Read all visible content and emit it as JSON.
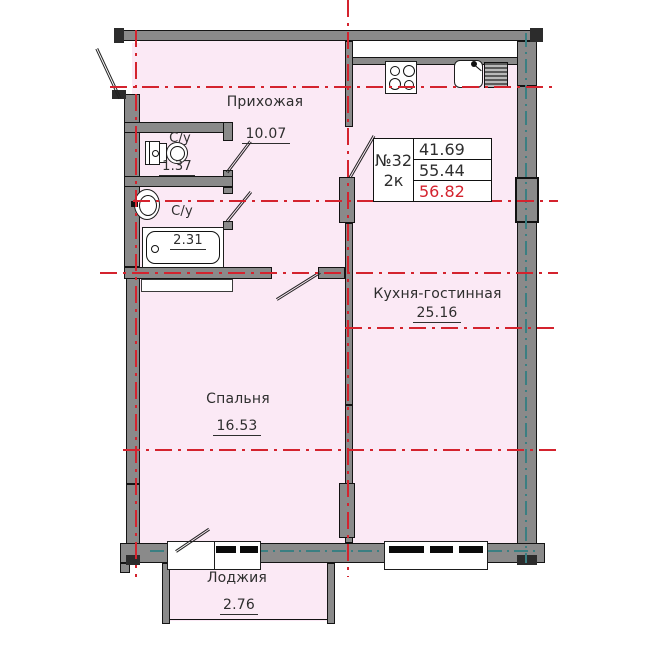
{
  "plan": {
    "title": "apartment-floor-plan",
    "info_box": {
      "number": "№32",
      "rooms_count": "2к",
      "area_1": "41.69",
      "area_2": "55.44",
      "area_3": "56.82"
    },
    "rooms": [
      {
        "id": "hallway",
        "name": "Прихожая",
        "area": "10.07"
      },
      {
        "id": "wc",
        "name": "С/у",
        "area": "1.37"
      },
      {
        "id": "bathroom",
        "name": "С/у",
        "area": "2.31"
      },
      {
        "id": "kitchen_living",
        "name": "Кухня-гостинная",
        "area": "25.16"
      },
      {
        "id": "bedroom",
        "name": "Спальня",
        "area": "16.53"
      },
      {
        "id": "loggia",
        "name": "Лоджия",
        "area": "2.76"
      }
    ],
    "colors": {
      "room_fill": "#fbe9f5",
      "wall_gray": "#8a8a8a",
      "axis_red": "#d4232e",
      "glazing_teal": "#3a7f82",
      "outline_black": "#141414",
      "total_area_red": "#d4232e"
    },
    "icons": [
      "stove-icon",
      "kitchen-sink-icon",
      "toilet-icon",
      "washing-machine-icon",
      "washbasin-icon",
      "bathtub-icon"
    ]
  }
}
